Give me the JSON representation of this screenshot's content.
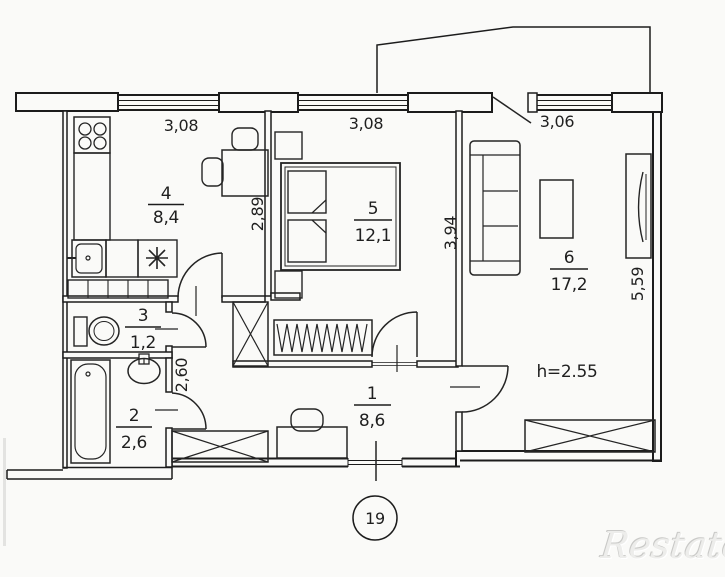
{
  "page": {
    "background": "#fafaf8",
    "line_color": "#1c1c1c",
    "watermark_color": "#ededeb"
  },
  "floor_plan": {
    "plan_number": "19",
    "ceiling_height_label": "h=2.55",
    "watermark": "Restate",
    "rooms": [
      {
        "number": "1",
        "area": "8,6"
      },
      {
        "number": "2",
        "area": "2,6"
      },
      {
        "number": "3",
        "area": "1,2"
      },
      {
        "number": "4",
        "area": "8,4"
      },
      {
        "number": "5",
        "area": "12,1"
      },
      {
        "number": "6",
        "area": "17,2"
      }
    ],
    "dims": {
      "win_kitchen": "3,08",
      "win_bedroom": "3,08",
      "win_living": "3,06",
      "depth_kitchen": "2,89",
      "depth_bedroom": "3,94",
      "depth_living": "5,59",
      "hall": "2,60"
    }
  }
}
